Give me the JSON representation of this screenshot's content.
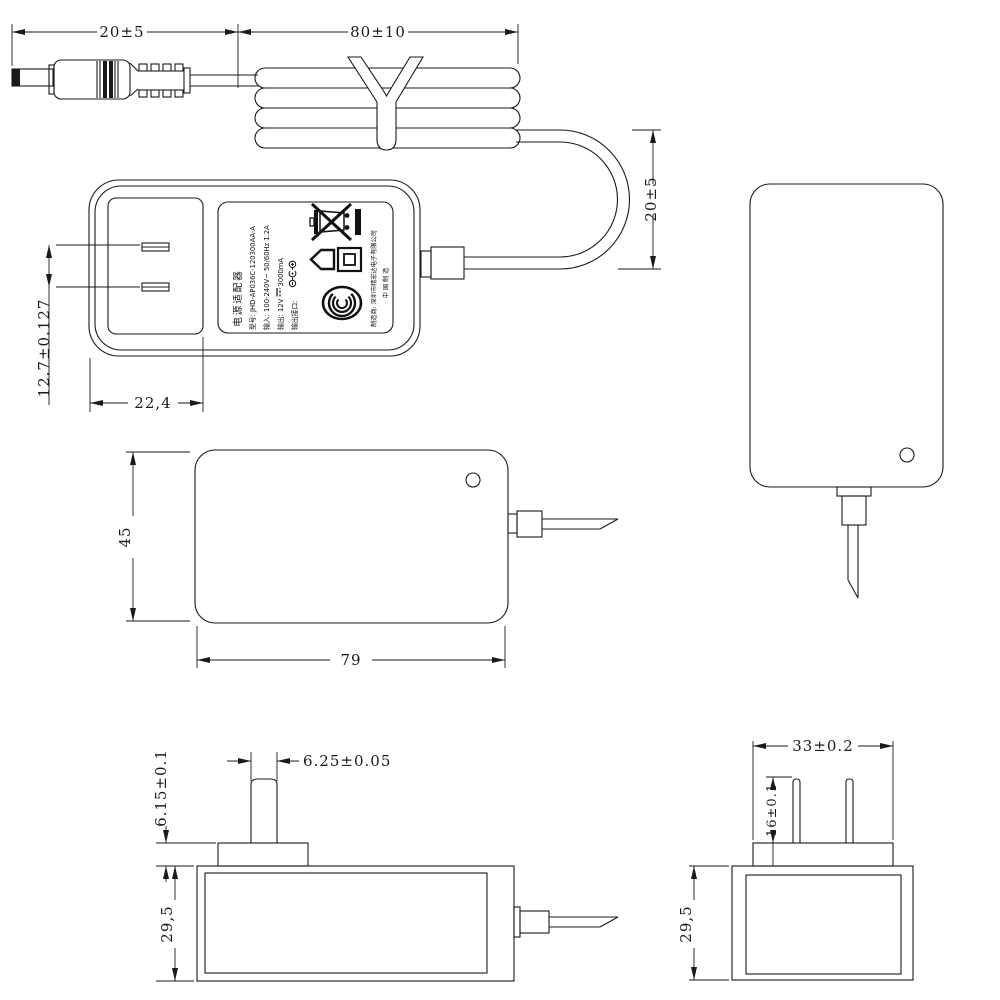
{
  "figure": {
    "kind": "technical dimensional drawing",
    "subject": "AC/DC wall power adapter with output cable",
    "line_color": "#1a1a1a",
    "background_color": "#ffffff"
  },
  "dimensions": {
    "plug_length": "20±5",
    "bundle_length": "80±10",
    "loop_height": "20±5",
    "pin_pitch": "12.7±0.127",
    "pin_area_offset": "22,4",
    "body_width": "45",
    "body_length": "79",
    "pin_blade_width": "6.25±0.05",
    "plug_base_height": "6.15±0.1",
    "body_thickness_side": "29,5",
    "plug_base_width": "33±0.2",
    "pin_length": "16±0.1",
    "body_thickness_end": "29,5"
  },
  "label": {
    "title": "电源适配器",
    "model": "型号: JHD-AP036C-120300AA-A",
    "input": "输入: 100-240V~ 50/60Hz 1.2A",
    "output_prefix": "输出: 12V",
    "dc_symbol": "⎓",
    "output_suffix": "3000mA",
    "port_label": "输出接口:",
    "manufacturer": "制造商: 深圳市精宏达电子有限公司",
    "made_in": "中 国 制 造",
    "icons": [
      "weee-crossed-bin-icon",
      "weee-solid-bar-icon",
      "indoor-use-house-icon",
      "class-ii-double-square-icon",
      "ccc-certification-icon",
      "dc-polarity-icon",
      "dc-current-symbol-icon"
    ]
  }
}
